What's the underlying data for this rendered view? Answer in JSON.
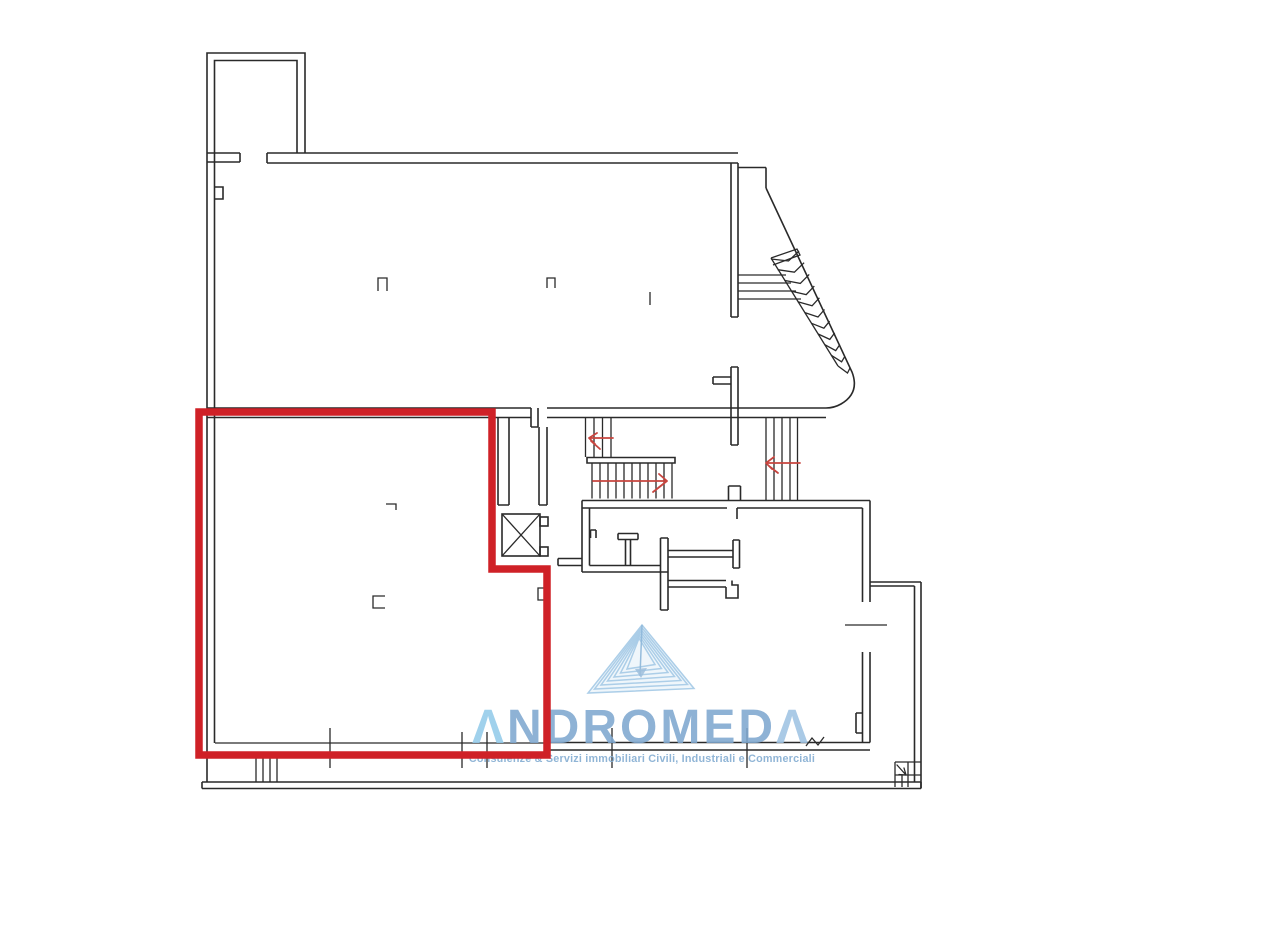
{
  "page": {
    "kind": "floor-plan-drawing",
    "background": "#ffffff"
  },
  "colors": {
    "line": "#2a2a2a",
    "highlight-red": "#cf2127",
    "arrow-red": "#c8453f",
    "logo-blue": "#7fa8d0",
    "logo-blue-light": "#93cbea",
    "logo-blue-mid": "#9fc3e3",
    "tagline-blue": "#87afd3",
    "triangle-blue": "#a8cbe7",
    "triangle-fill": "#d6e7f4",
    "bg": "#ffffff"
  },
  "logo": {
    "first_letter": "Λ",
    "middle": "NDROMED",
    "last_letter": "Λ",
    "tagline": "Consulenze & Servizi immobiliari Civili, Industriali e Commerciali"
  },
  "icons": {
    "elevator_shaft": "crossed-square elevator symbol",
    "stair_direction_arrows": "red arrows on stair flights",
    "triangle_logo": "layered mountain triangle logomark"
  }
}
